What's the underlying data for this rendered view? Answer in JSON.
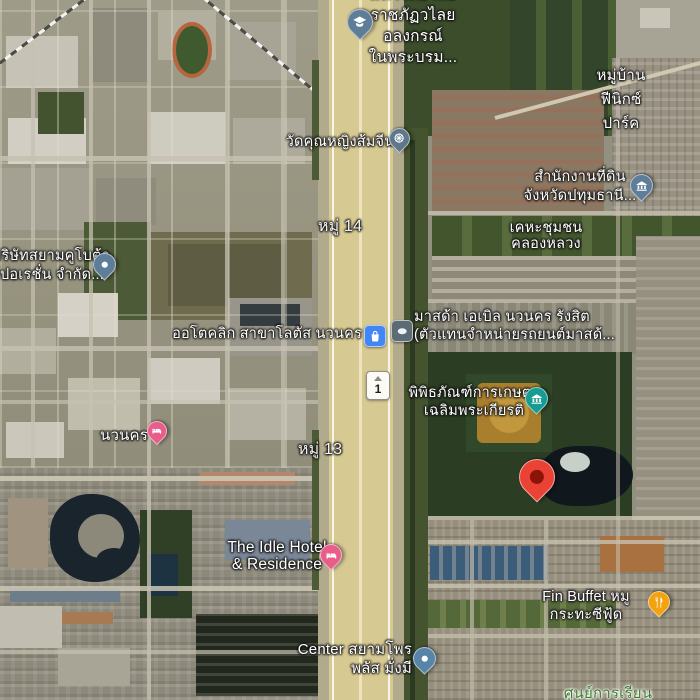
{
  "map": {
    "view_type": "satellite-map",
    "road_shield": {
      "route_number": "1"
    },
    "labels": [
      {
        "id": "university",
        "category": "university",
        "lines": [
          "มหาวิทยาลัย",
          "ราชภัฏวไลย",
          "อลงกรณ์",
          "ในพระบรม..."
        ],
        "text": {
          "x": 413,
          "y": -16,
          "align": "center",
          "size": 15.5,
          "line_height": 21
        },
        "text_color": "#ffffff",
        "halo": "dark",
        "pin": {
          "kind": "drop",
          "icon": "graduation-cap-icon",
          "color": "#5e7d98",
          "size": 26,
          "x": 360,
          "y": 22
        }
      },
      {
        "id": "wat-khunying-somchin",
        "category": "temple",
        "lines": [
          "วัดคุณหญิงส้มจีน"
        ],
        "text": {
          "x": 340,
          "y": 134,
          "align": "center",
          "size": 14.5,
          "line_height": 17
        },
        "text_color": "#ffffff",
        "halo": "dark",
        "pin": {
          "kind": "drop",
          "icon": "dharma-wheel-icon",
          "color": "#5e7889",
          "size": 21,
          "x": 399,
          "y": 138
        }
      },
      {
        "id": "phoenix-park-village",
        "category": "residential-area",
        "lines": [
          "หมู่บ้าน",
          "ฟีนิกซ์",
          "ปาร์ค"
        ],
        "text": {
          "x": 621,
          "y": 64,
          "align": "center",
          "size": 15,
          "line_height": 24
        },
        "text_color": "#ffffff",
        "halo": "dark"
      },
      {
        "id": "pathum-thani-land-office",
        "category": "government-office",
        "lines": [
          "สำนักงานที่ดิน",
          "จังหวัดปทุมธานี..."
        ],
        "text": {
          "x": 580,
          "y": 168,
          "align": "center",
          "size": 14.5,
          "line_height": 19
        },
        "text_color": "#ffffff",
        "halo": "dark",
        "pin": {
          "kind": "drop",
          "icon": "government-building-icon",
          "color": "#5e7d98",
          "size": 23,
          "x": 641,
          "y": 185
        }
      },
      {
        "id": "khlong-luang-community",
        "category": "residential-area",
        "lines": [
          "เคหะชุมชน",
          "คลองหลวง"
        ],
        "text": {
          "x": 546,
          "y": 220,
          "align": "center",
          "size": 14.5,
          "line_height": 16
        },
        "text_color": "#ffffff",
        "halo": "dark"
      },
      {
        "id": "siam-kubota-corporation",
        "category": "company",
        "lines": [
          "บริษัทสยามคูโบต้า",
          "ร์ปอเรชั่น จำกัด..."
        ],
        "text": {
          "x": -8,
          "y": 247,
          "align": "left",
          "size": 14.5,
          "line_height": 19
        },
        "text_color": "#ffffff",
        "halo": "dark",
        "pin": {
          "kind": "drop",
          "icon": "place-dot-icon",
          "color": "#5e7d98",
          "size": 23,
          "x": 104,
          "y": 264
        }
      },
      {
        "id": "moo-14",
        "category": "locality",
        "lines": [
          "หมู่ 14"
        ],
        "text": {
          "x": 340,
          "y": 218,
          "align": "center",
          "size": 16,
          "line_height": 18
        },
        "text_color": "#f3f3f3",
        "halo": "dark"
      },
      {
        "id": "autoclick-lotus-navanakorn",
        "category": "shopping",
        "lines": [
          "ออโตคลิก สาขาโลตัส นวนคร"
        ],
        "text": {
          "x": 362,
          "y": 326,
          "align": "right",
          "size": 14.5,
          "line_height": 17
        },
        "text_color": "#ffffff",
        "halo": "dark",
        "pin": {
          "kind": "badge",
          "icon": "shopping-bag-icon",
          "color": "#4285f4",
          "size": 20,
          "x": 374,
          "y": 335
        }
      },
      {
        "id": "mazda-able-navanakorn-rangsit",
        "category": "car-dealer",
        "lines": [
          "มาสด้า เอเบิล นวนคร รังสิต",
          "(ตัวแทนจำหน่ายรถยนต์มาสด้..."
        ],
        "text": {
          "x": 414,
          "y": 309,
          "align": "left",
          "size": 14.5,
          "line_height": 17.5
        },
        "text_color": "#ffffff",
        "halo": "dark",
        "pin": {
          "kind": "badge",
          "icon": "car-logo-icon",
          "color": "#5d6b74",
          "size": 20,
          "x": 401,
          "y": 330
        }
      },
      {
        "id": "agricultural-museum",
        "category": "museum",
        "lines": [
          "พิพิธภัณฑ์การเกษตร",
          "เฉลิมพระเกียรติ"
        ],
        "text": {
          "x": 474,
          "y": 384,
          "align": "center",
          "size": 14.5,
          "line_height": 18
        },
        "text_color": "#ffffff",
        "halo": "dark",
        "pin": {
          "kind": "drop",
          "icon": "museum-icon",
          "color": "#169c93",
          "size": 23,
          "x": 536,
          "y": 398
        }
      },
      {
        "id": "destination-marker",
        "category": "destination",
        "lines": [],
        "pin": {
          "kind": "marker",
          "color": "#ea4335",
          "inner_color": "#8c1308",
          "size": 36,
          "x": 537,
          "y": 477
        }
      },
      {
        "id": "navanakorn-hotel",
        "category": "hotel",
        "lines": [
          "นวนคร"
        ],
        "text": {
          "x": 124,
          "y": 427,
          "align": "center",
          "size": 15,
          "line_height": 17
        },
        "text_color": "#ffffff",
        "halo": "dark",
        "pin": {
          "kind": "drop",
          "icon": "hotel-bed-icon",
          "color": "#e85d8a",
          "size": 20,
          "x": 157,
          "y": 431
        }
      },
      {
        "id": "moo-13",
        "category": "locality",
        "lines": [
          "หมู่ 13"
        ],
        "text": {
          "x": 320,
          "y": 441,
          "align": "center",
          "size": 16,
          "line_height": 18
        },
        "text_color": "#f3f3f3",
        "halo": "dark"
      },
      {
        "id": "idle-hotel-residence",
        "category": "hotel",
        "lines": [
          "The Idle Hotel",
          "& Residence"
        ],
        "text": {
          "x": 277,
          "y": 539,
          "align": "center",
          "size": 15.5,
          "line_height": 17
        },
        "text_color": "#ffffff",
        "halo": "dark",
        "pin": {
          "kind": "drop",
          "icon": "hotel-bed-icon",
          "color": "#e85d8a",
          "size": 22,
          "x": 331,
          "y": 555
        }
      },
      {
        "id": "fin-buffet-mookata-seafood",
        "category": "restaurant",
        "lines": [
          "Fin Buffet หมู",
          "กระทะซีฟู้ด"
        ],
        "text": {
          "x": 586,
          "y": 588,
          "align": "center",
          "size": 14.5,
          "line_height": 18
        },
        "text_color": "#ffffff",
        "halo": "dark",
        "pin": {
          "kind": "drop",
          "icon": "restaurant-icon",
          "color": "#f2a30f",
          "size": 22,
          "x": 659,
          "y": 602
        }
      },
      {
        "id": "center-siam-pro-plus-mangmee",
        "category": "company",
        "lines": [
          "Center สยามโพร",
          "พลัส มั่งมี"
        ],
        "text": {
          "x": 412,
          "y": 640,
          "align": "right",
          "size": 15,
          "line_height": 19
        },
        "text_color": "#ffffff",
        "halo": "dark",
        "pin": {
          "kind": "drop",
          "icon": "place-dot-icon",
          "color": "#5884a8",
          "size": 23,
          "x": 424,
          "y": 658
        }
      },
      {
        "id": "learning-center",
        "category": "school",
        "lines": [
          "ศูนย์การเรียน"
        ],
        "text": {
          "x": 608,
          "y": 685,
          "align": "center",
          "size": 15,
          "line_height": 18
        },
        "text_color": "#3f7d2f",
        "halo": "light"
      }
    ]
  }
}
